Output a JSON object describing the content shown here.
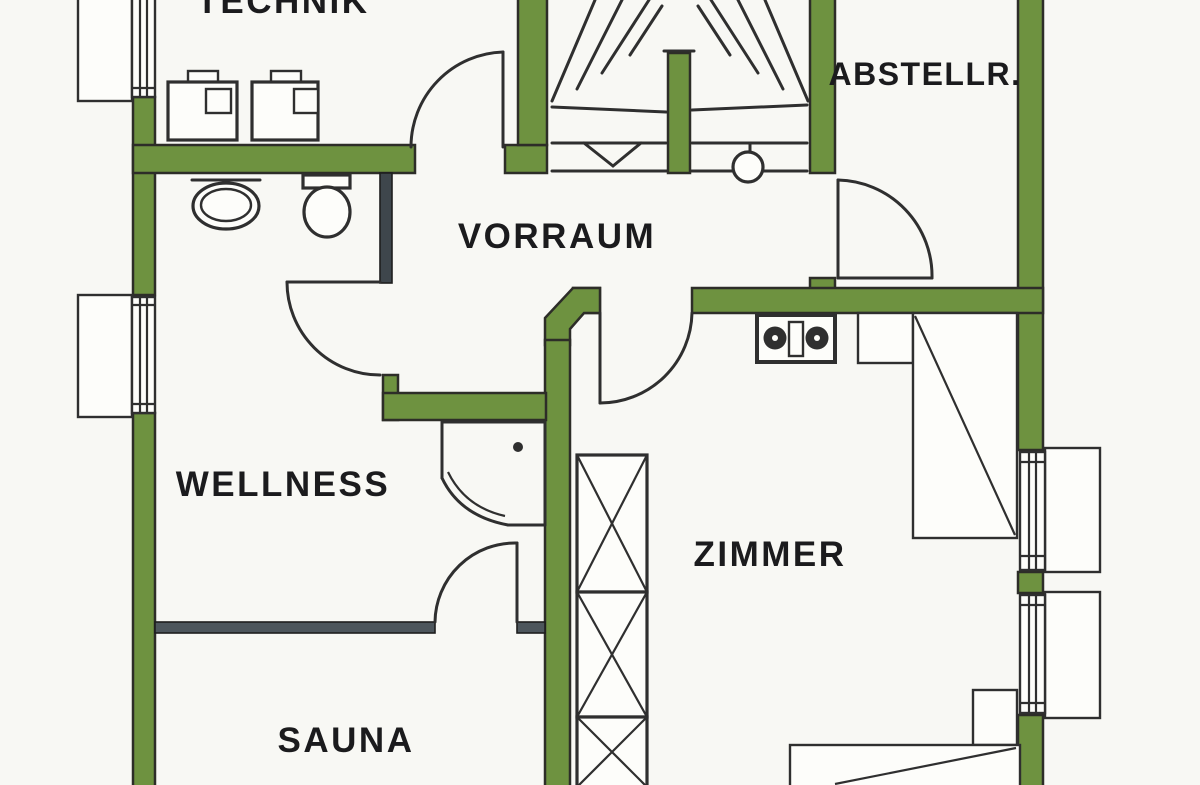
{
  "plan": {
    "type": "floor-plan",
    "rooms": [
      {
        "id": "technik",
        "label": "TECHNIK"
      },
      {
        "id": "vorraum",
        "label": "VORRAUM"
      },
      {
        "id": "abstellraum",
        "label": "ABSTELLR."
      },
      {
        "id": "wellness",
        "label": "WELLNESS"
      },
      {
        "id": "zimmer",
        "label": "ZIMMER"
      },
      {
        "id": "sauna",
        "label": "SAUNA"
      }
    ],
    "fixtures": [
      "staircase-winder",
      "stair-newel-circle",
      "chimney-x-hatch",
      "equipment-unit-1",
      "equipment-unit-2",
      "sink-basin",
      "toilet",
      "corner-shower",
      "double-knob-fixture",
      "wardrobe",
      "nightstand",
      "bed",
      "window-top-left",
      "window-mid-left",
      "window-right-upper",
      "window-right-lower"
    ]
  },
  "colors": {
    "wall": "#6e9240",
    "outline": "#2d2d28",
    "line": "#2f2f2f",
    "divider": "#4d565c",
    "partition": "#3e464c",
    "bg": "#f8f8f4",
    "paper": "#fdfdfa",
    "text": "#1b1b1d"
  }
}
